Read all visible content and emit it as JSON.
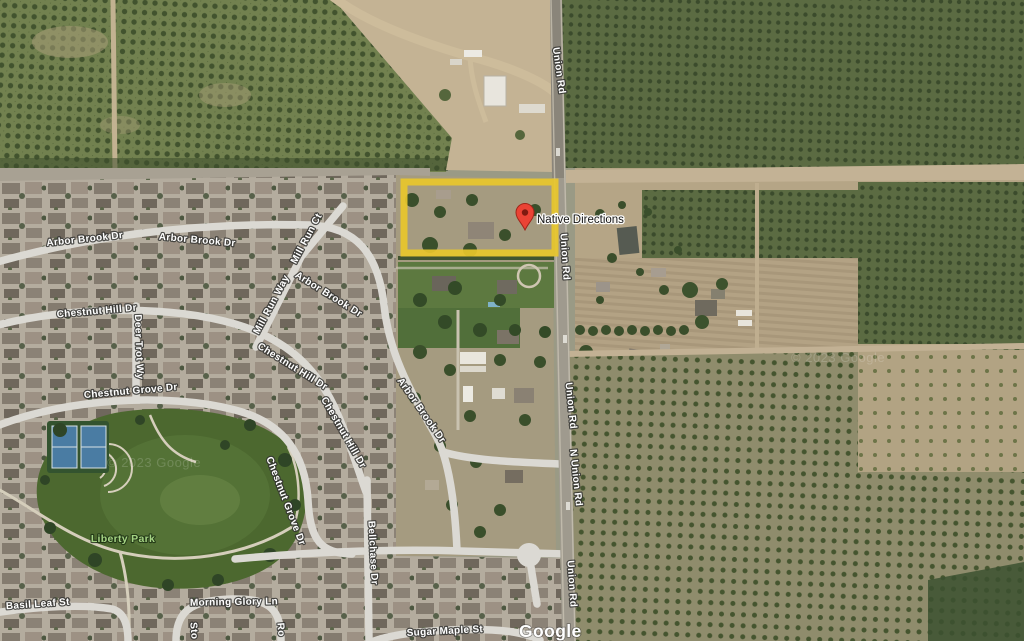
{
  "map_type": "satellite",
  "streets": {
    "arbor_brook_dr": "Arbor Brook Dr",
    "mill_run_ct": "Mill Run Ct",
    "mill_run_way": "Mill Run Way",
    "chestnut_hill_dr": "Chestnut Hill Dr",
    "deer_trot_wy": "Deer Trot Wy",
    "chestnut_grove_dr": "Chestnut Grove Dr",
    "bellchase_dr": "Bellchase Dr",
    "basil_leaf_st": "Basil Leaf St",
    "morning_glory_ln": "Morning Glory Ln",
    "sugar_maple_st": "Sugar Maple St",
    "union_rd": "Union Rd",
    "n_union_rd": "N Union Rd",
    "partial_street_left": "Sto",
    "partial_street_right": "Ro"
  },
  "pin": {
    "label": "Native Directions",
    "color": "#ea4335"
  },
  "park": {
    "label": "Liberty Park",
    "label_color": "#a5d384"
  },
  "highlight": {
    "shape": "rectangle",
    "color": "#e8c72b"
  },
  "attribution": {
    "logo": "Google",
    "watermark": "© 2023 Google"
  }
}
